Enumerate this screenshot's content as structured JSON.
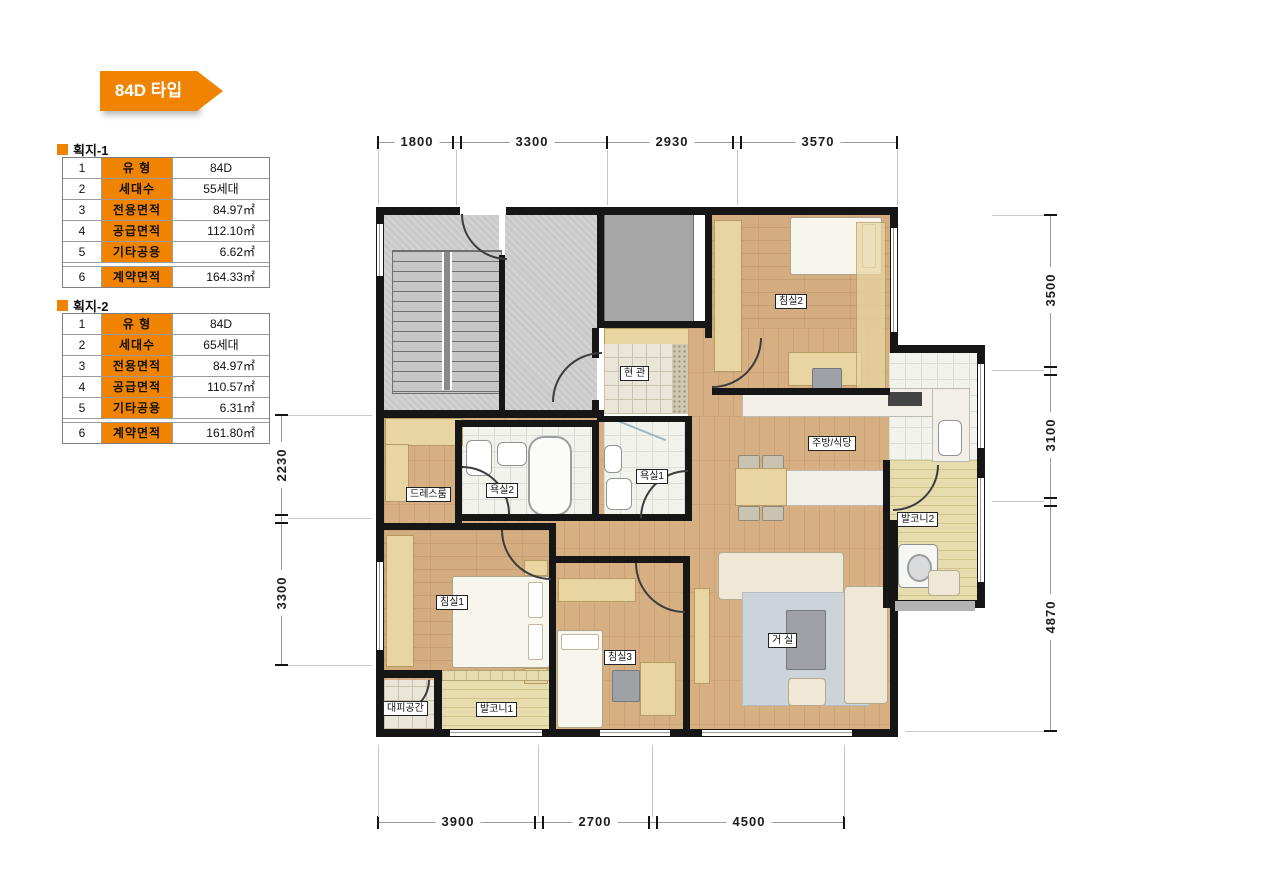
{
  "badge": {
    "label": "84D 타입"
  },
  "tables": [
    {
      "heading": "획지-1",
      "rows": [
        {
          "no": "1",
          "label": "유 형",
          "value": "84D"
        },
        {
          "no": "2",
          "label": "세대수",
          "value": "55세대"
        },
        {
          "no": "3",
          "label": "전용면적",
          "value": "84.97㎡"
        },
        {
          "no": "4",
          "label": "공급면적",
          "value": "112.10㎡"
        },
        {
          "no": "5",
          "label": "기타공용",
          "value": "6.62㎡"
        },
        {
          "no": "6",
          "label": "계약면적",
          "value": "164.33㎡"
        }
      ]
    },
    {
      "heading": "획지-2",
      "rows": [
        {
          "no": "1",
          "label": "유 형",
          "value": "84D"
        },
        {
          "no": "2",
          "label": "세대수",
          "value": "65세대"
        },
        {
          "no": "3",
          "label": "전용면적",
          "value": "84.97㎡"
        },
        {
          "no": "4",
          "label": "공급면적",
          "value": "110.57㎡"
        },
        {
          "no": "5",
          "label": "기타공용",
          "value": "6.31㎡"
        },
        {
          "no": "6",
          "label": "계약면적",
          "value": "161.80㎡"
        }
      ]
    }
  ],
  "dimensions": {
    "top": [
      "1800",
      "3300",
      "2930",
      "3570"
    ],
    "bottom": [
      "3900",
      "2700",
      "4500"
    ],
    "left": [
      "2230",
      "3300"
    ],
    "right": [
      "3500",
      "3100",
      "4870"
    ]
  },
  "plan": {
    "rooms": {
      "bedroom1": "침실1",
      "bedroom2": "침실2",
      "bedroom3": "침실3",
      "living": "거 실",
      "kitchen_dining": "주방/식당",
      "entry": "현 관",
      "bath1": "욕실1",
      "bath2": "욕실2",
      "dressroom": "드레스룸",
      "balcony1": "발코니1",
      "balcony2": "발코니2",
      "shelter": "대피공간"
    }
  },
  "colors": {
    "accent_orange": "#F08300",
    "wall": "#161616",
    "wood_floor": "#d3ac80",
    "hall_gray": "#c9c9c9",
    "balcony_floor": "#e6dcae"
  }
}
